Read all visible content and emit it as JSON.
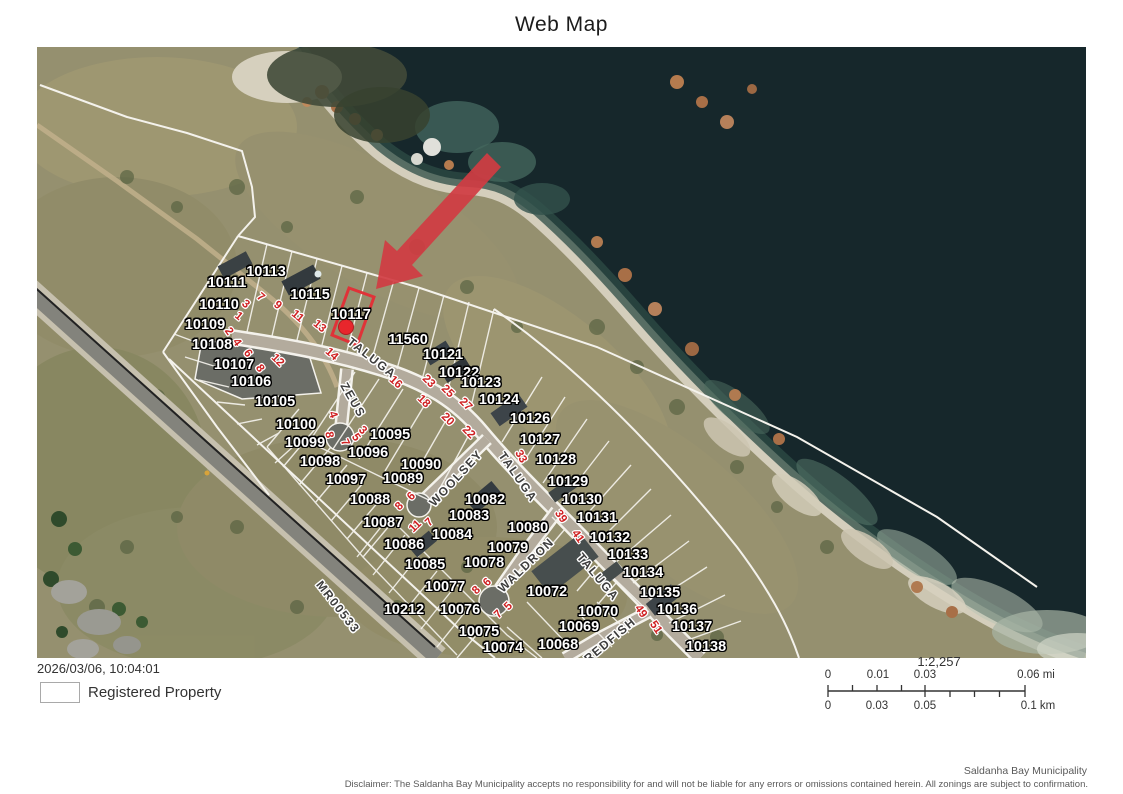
{
  "title": "Web Map",
  "footer": {
    "datetime": "2026/03/06, 10:04:01",
    "legend_label": "Registered Property",
    "attribution": "Saldanha Bay Municipality",
    "disclaimer": "Disclaimer: The Saldanha Bay Municipality accepts no responsibility for and will not be liable for any errors or omissions contained herein.  All zonings are subject to confirmation."
  },
  "scale": {
    "ratio": "1:2,257",
    "miles": [
      "0",
      "0.01",
      "0.03",
      "0.06 mi"
    ],
    "km": [
      "0",
      "0.03",
      "0.05",
      "0.1 km"
    ]
  },
  "map": {
    "highlighted_parcel": "10117",
    "colors": {
      "highlight_red": "#d03c42",
      "ocean": "#16272b",
      "marker_red": "#e8262c"
    },
    "parcels": [
      {
        "label": "10113",
        "x": 229,
        "y": 225
      },
      {
        "label": "10111",
        "x": 190,
        "y": 236
      },
      {
        "label": "10110",
        "x": 182,
        "y": 258
      },
      {
        "label": "10109",
        "x": 168,
        "y": 278
      },
      {
        "label": "10108",
        "x": 175,
        "y": 298
      },
      {
        "label": "10107",
        "x": 197,
        "y": 318
      },
      {
        "label": "10106",
        "x": 214,
        "y": 335
      },
      {
        "label": "10105",
        "x": 238,
        "y": 355
      },
      {
        "label": "10115",
        "x": 273,
        "y": 248
      },
      {
        "label": "10117",
        "x": 314,
        "y": 268
      },
      {
        "label": "11560",
        "x": 371,
        "y": 293
      },
      {
        "label": "10121",
        "x": 406,
        "y": 308
      },
      {
        "label": "10122",
        "x": 422,
        "y": 326
      },
      {
        "label": "10123",
        "x": 444,
        "y": 336
      },
      {
        "label": "10124",
        "x": 462,
        "y": 353
      },
      {
        "label": "10126",
        "x": 493,
        "y": 372
      },
      {
        "label": "10127",
        "x": 503,
        "y": 393
      },
      {
        "label": "10128",
        "x": 519,
        "y": 413
      },
      {
        "label": "10129",
        "x": 531,
        "y": 435
      },
      {
        "label": "10130",
        "x": 545,
        "y": 453
      },
      {
        "label": "10131",
        "x": 560,
        "y": 471
      },
      {
        "label": "10132",
        "x": 573,
        "y": 491
      },
      {
        "label": "10133",
        "x": 591,
        "y": 508
      },
      {
        "label": "10134",
        "x": 606,
        "y": 526
      },
      {
        "label": "10135",
        "x": 623,
        "y": 546
      },
      {
        "label": "10136",
        "x": 640,
        "y": 563
      },
      {
        "label": "10137",
        "x": 655,
        "y": 580
      },
      {
        "label": "10138",
        "x": 669,
        "y": 600
      },
      {
        "label": "10100",
        "x": 259,
        "y": 378
      },
      {
        "label": "10099",
        "x": 268,
        "y": 396
      },
      {
        "label": "10098",
        "x": 283,
        "y": 415
      },
      {
        "label": "10097",
        "x": 309,
        "y": 433
      },
      {
        "label": "10096",
        "x": 331,
        "y": 406
      },
      {
        "label": "10095",
        "x": 353,
        "y": 388
      },
      {
        "label": "10090",
        "x": 384,
        "y": 418
      },
      {
        "label": "10089",
        "x": 366,
        "y": 432
      },
      {
        "label": "10088",
        "x": 333,
        "y": 453
      },
      {
        "label": "10087",
        "x": 346,
        "y": 476
      },
      {
        "label": "10086",
        "x": 367,
        "y": 498
      },
      {
        "label": "10085",
        "x": 388,
        "y": 518
      },
      {
        "label": "10084",
        "x": 415,
        "y": 488
      },
      {
        "label": "10083",
        "x": 432,
        "y": 469
      },
      {
        "label": "10082",
        "x": 448,
        "y": 453
      },
      {
        "label": "10080",
        "x": 491,
        "y": 481
      },
      {
        "label": "10079",
        "x": 471,
        "y": 501
      },
      {
        "label": "10078",
        "x": 447,
        "y": 516
      },
      {
        "label": "10077",
        "x": 408,
        "y": 540
      },
      {
        "label": "10076",
        "x": 423,
        "y": 563
      },
      {
        "label": "10075",
        "x": 442,
        "y": 585
      },
      {
        "label": "10074",
        "x": 466,
        "y": 601
      },
      {
        "label": "10212",
        "x": 367,
        "y": 563
      },
      {
        "label": "10072",
        "x": 510,
        "y": 545
      },
      {
        "label": "10070",
        "x": 561,
        "y": 565
      },
      {
        "label": "10069",
        "x": 542,
        "y": 580
      },
      {
        "label": "10068",
        "x": 521,
        "y": 598
      }
    ],
    "streets": [
      {
        "label": "TALUGA",
        "x": 335,
        "y": 311,
        "rot": 38
      },
      {
        "label": "TALUGA",
        "x": 481,
        "y": 430,
        "rot": 55
      },
      {
        "label": "TALUGA",
        "x": 561,
        "y": 530,
        "rot": 50
      },
      {
        "label": "ZEUS",
        "x": 316,
        "y": 353,
        "rot": 60
      },
      {
        "label": "WOOLSEY",
        "x": 419,
        "y": 431,
        "rot": -47
      },
      {
        "label": "WALDRON",
        "x": 489,
        "y": 518,
        "rot": -44
      },
      {
        "label": "REDFISH",
        "x": 573,
        "y": 593,
        "rot": -40
      },
      {
        "label": "MR00533",
        "x": 301,
        "y": 560,
        "rot": 52
      }
    ],
    "house_numbers": [
      {
        "label": "1",
        "x": 201,
        "y": 270,
        "rot": 40
      },
      {
        "label": "3",
        "x": 208,
        "y": 258,
        "rot": 40
      },
      {
        "label": "7",
        "x": 223,
        "y": 251,
        "rot": 40
      },
      {
        "label": "9",
        "x": 240,
        "y": 259,
        "rot": 40
      },
      {
        "label": "11",
        "x": 260,
        "y": 270,
        "rot": 40
      },
      {
        "label": "13",
        "x": 282,
        "y": 280,
        "rot": 40
      },
      {
        "label": "2",
        "x": 191,
        "y": 285,
        "rot": 55
      },
      {
        "label": "4",
        "x": 199,
        "y": 296,
        "rot": 55
      },
      {
        "label": "6",
        "x": 210,
        "y": 307,
        "rot": 55
      },
      {
        "label": "8",
        "x": 222,
        "y": 322,
        "rot": 55
      },
      {
        "label": "12",
        "x": 240,
        "y": 314,
        "rot": 45
      },
      {
        "label": "14",
        "x": 294,
        "y": 308,
        "rot": 42
      },
      {
        "label": "16",
        "x": 358,
        "y": 336,
        "rot": 42
      },
      {
        "label": "23",
        "x": 391,
        "y": 335,
        "rot": 45
      },
      {
        "label": "25",
        "x": 410,
        "y": 345,
        "rot": 45
      },
      {
        "label": "27",
        "x": 428,
        "y": 358,
        "rot": 45
      },
      {
        "label": "18",
        "x": 386,
        "y": 355,
        "rot": 45
      },
      {
        "label": "20",
        "x": 410,
        "y": 373,
        "rot": 45
      },
      {
        "label": "22",
        "x": 431,
        "y": 386,
        "rot": 45
      },
      {
        "label": "33",
        "x": 483,
        "y": 410,
        "rot": 60
      },
      {
        "label": "39",
        "x": 523,
        "y": 470,
        "rot": 55
      },
      {
        "label": "41",
        "x": 540,
        "y": 490,
        "rot": 55
      },
      {
        "label": "49",
        "x": 603,
        "y": 565,
        "rot": 55
      },
      {
        "label": "51",
        "x": 618,
        "y": 581,
        "rot": 55
      },
      {
        "label": "4",
        "x": 295,
        "y": 368,
        "rot": 70
      },
      {
        "label": "3",
        "x": 325,
        "y": 384,
        "rot": 45
      },
      {
        "label": "5",
        "x": 318,
        "y": 391,
        "rot": 55
      },
      {
        "label": "7",
        "x": 307,
        "y": 396,
        "rot": 65
      },
      {
        "label": "8",
        "x": 291,
        "y": 388,
        "rot": 80
      },
      {
        "label": "6",
        "x": 375,
        "y": 450,
        "rot": -45
      },
      {
        "label": "8",
        "x": 363,
        "y": 460,
        "rot": -45
      },
      {
        "label": "7",
        "x": 393,
        "y": 476,
        "rot": -45
      },
      {
        "label": "11",
        "x": 379,
        "y": 480,
        "rot": -45
      },
      {
        "label": "6",
        "x": 451,
        "y": 536,
        "rot": -45
      },
      {
        "label": "8",
        "x": 440,
        "y": 544,
        "rot": -45
      },
      {
        "label": "5",
        "x": 472,
        "y": 560,
        "rot": -45
      },
      {
        "label": "7",
        "x": 462,
        "y": 568,
        "rot": -45
      }
    ]
  }
}
